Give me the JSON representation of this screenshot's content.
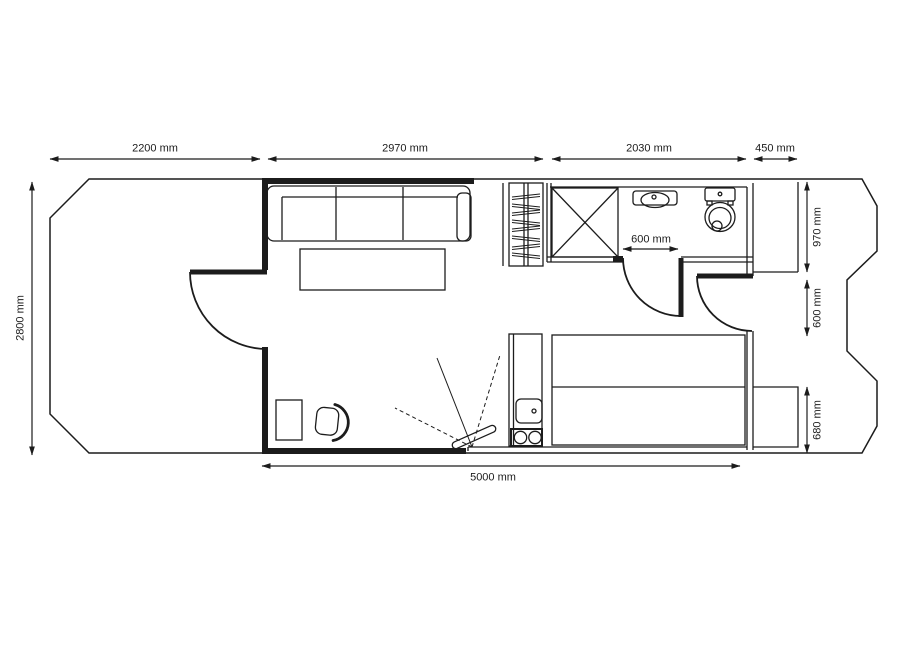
{
  "drawing": {
    "kind": "floor-plan",
    "line_color": "#1c1c1c",
    "background_color": "#ffffff"
  },
  "dimensions": {
    "top": [
      {
        "label": "2200 mm"
      },
      {
        "label": "2970 mm"
      },
      {
        "label": "2030 mm"
      },
      {
        "label": "450 mm"
      }
    ],
    "left": {
      "label": "2800 mm"
    },
    "right": [
      {
        "label": "970 mm"
      },
      {
        "label": "600 mm"
      },
      {
        "label": "680 mm"
      }
    ],
    "bathroom_door": {
      "label": "600 mm"
    },
    "bottom": {
      "label": "5000 mm"
    }
  },
  "icons": [
    "hull-outline",
    "entry-door",
    "sofa",
    "coffee-table",
    "roof-ladder",
    "shower",
    "washbasin",
    "toilet",
    "bathroom-door",
    "deck-door",
    "side-deck",
    "kitchenette",
    "bed",
    "stern-platform",
    "desk",
    "office-chair",
    "tv-swivel-arm"
  ]
}
